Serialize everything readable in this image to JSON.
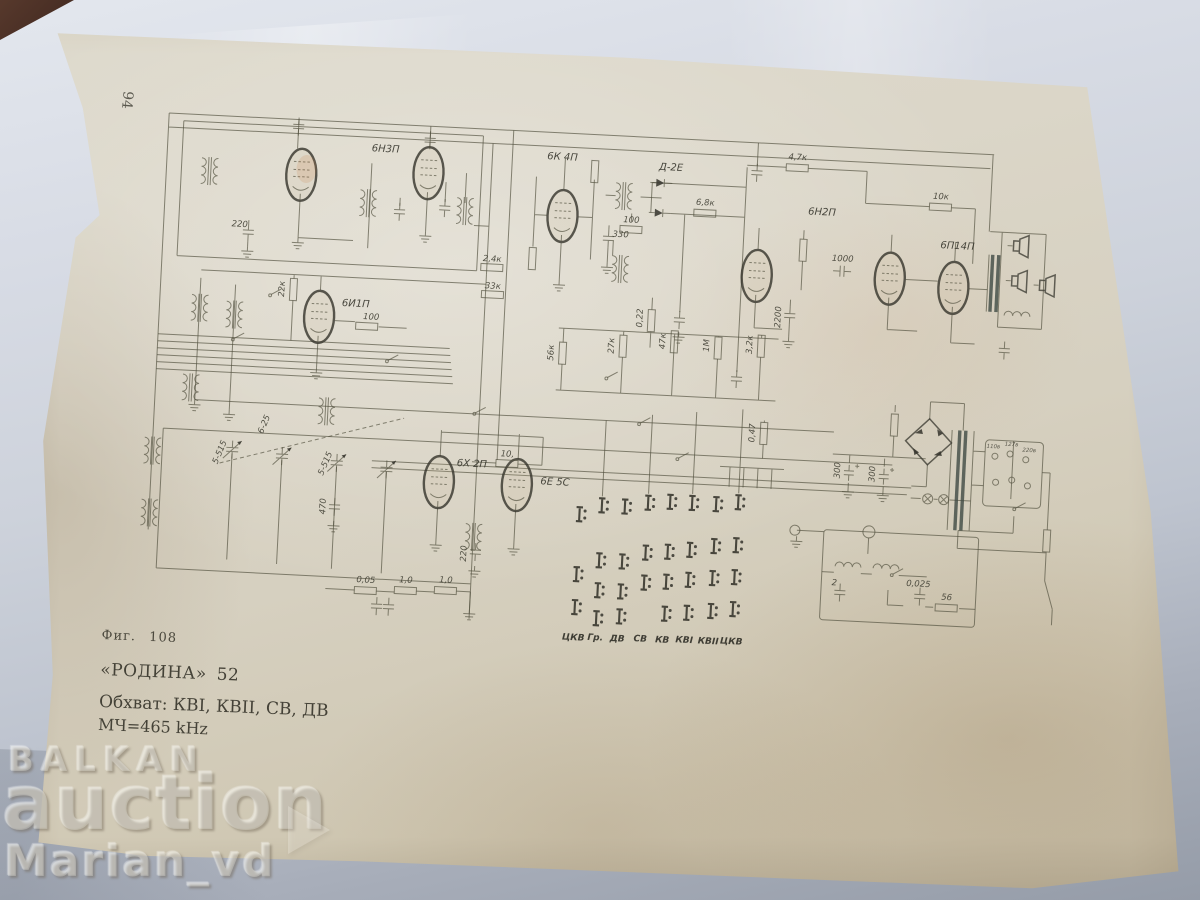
{
  "page": {
    "number": "94"
  },
  "caption": {
    "figure": "Фиг. 108",
    "model": "«РОДИНА» 52",
    "bands": "Обхват: КВI, КВII, СВ, ДВ",
    "if_frequency": "МЧ=465 kHz"
  },
  "watermark": {
    "brand_top": "BALKAN",
    "brand_bottom": "auction",
    "user": "Marian_vd"
  },
  "schematic": {
    "tube_labels": [
      "6Н3П",
      "6К 4П",
      "Д-2Е",
      "6Н2П",
      "6П14П",
      "6И1П",
      "6Х 2П",
      "6Е 5С"
    ],
    "values": [
      "4,7к",
      "10к",
      "2,4к",
      "33к",
      "6,8к",
      "100",
      "100",
      "330",
      "220",
      "2200",
      "1000",
      "56к",
      "27к",
      "0,22",
      "47к",
      "1М",
      "3,2к",
      "0,47",
      "22к",
      "10,",
      "0,05",
      "1,0",
      "1,0",
      "5-515",
      "5-515",
      "6-25",
      "470",
      "220",
      "2",
      "0,025",
      "56",
      "300",
      "300"
    ],
    "bands": [
      "ЦКВ",
      "Гр.",
      "ДВ",
      "СВ",
      "КВ",
      "КВI",
      "КВII",
      "ЦКВ"
    ],
    "selector_voltages": [
      "110в",
      "127в",
      "220в"
    ],
    "ink_color": "#52513f",
    "paper_color": "#d8d3c4",
    "cloth_color": "#c7ccd8"
  }
}
